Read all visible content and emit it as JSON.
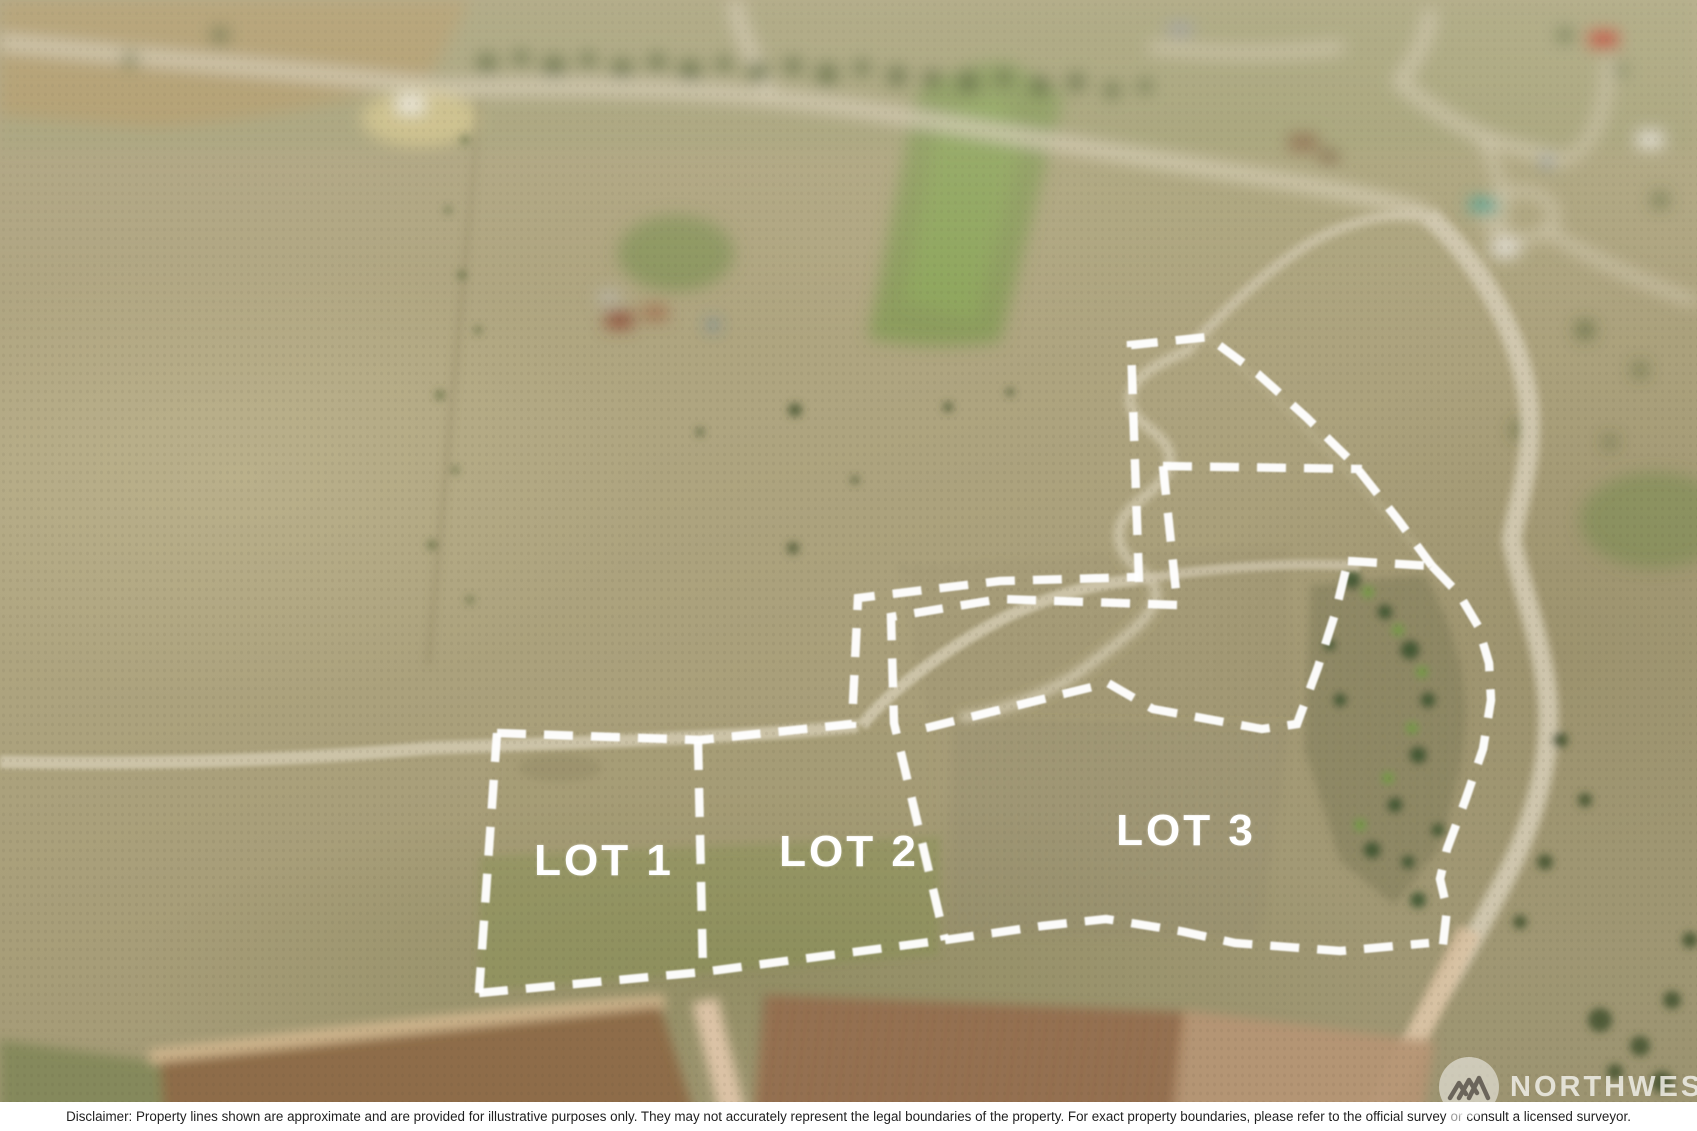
{
  "lot_labels": {
    "lot1": "LOT 1",
    "lot2": "LOT 2",
    "lot3": "LOT 3"
  },
  "watermark": {
    "brand": "NORTHWEST",
    "logo_icon": "mountain-peaks-icon"
  },
  "disclaimer": {
    "part1": "Disclaimer: Property lines shown are approximate and are provided for illustrative purposes only. They may not accurately represent the legal boundaries of the property. For exact property boundaries, please refer to the official survey",
    "part2": "or",
    "part3": "consult a licensed surveyor."
  },
  "colors": {
    "boundary_line": "#ffffff",
    "lot_label_text": "#ffffff",
    "disclaimer_bg": "#ffffff",
    "disclaimer_text": "#1f1f1f",
    "watermark_text": "#f0eee8"
  },
  "boundaries": {
    "stroke_width": 8.5,
    "dash_pattern": "29 18",
    "paths": [
      "1139,582 1131,345 1208,337 1258,374 1306,417 1353,463 1399,521 1432,566",
      "1163,466 1362,469",
      "1163,466 1177,601",
      "497,733 700,740 852,724 858,598 1000,581 1139,577",
      "1177,605 1000,599 891,617 894,723 945,940",
      "698,741 703,972",
      "497,733 479,993",
      "479,993 703,972 945,940",
      "945,940 1042,926 1106,919 1180,931 1235,943 1340,951 1429,943",
      "926,728 1108,683 1153,709 1262,729 1297,724 1318,667 1335,614 1348,561",
      "1348,561 1432,566",
      "1432,566 1459,594 1478,626 1489,663 1491,700 1483,749 1465,801 1447,849 1440,879 1447,909 1443,945 1429,943"
    ]
  }
}
